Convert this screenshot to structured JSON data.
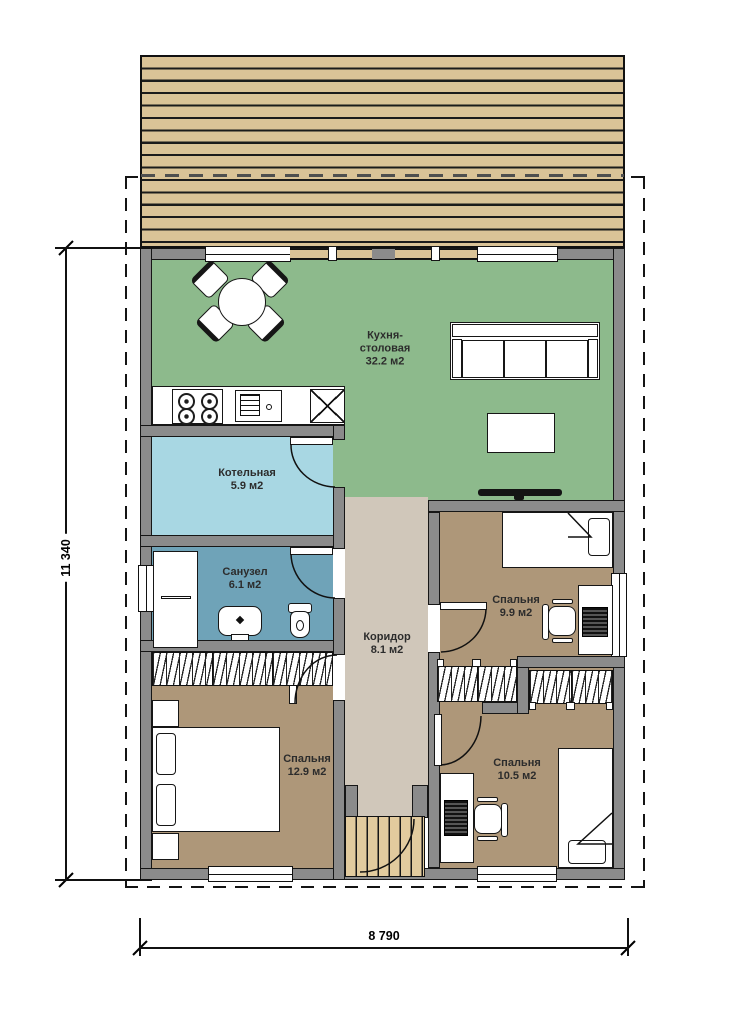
{
  "plan": {
    "type": "floor-plan",
    "dimensions": {
      "vertical": "11 340",
      "horizontal": "8 790"
    },
    "rooms": [
      {
        "id": "kitchen-dining",
        "lines": [
          "Кухня-",
          "столовая"
        ],
        "area": "32.2 м2"
      },
      {
        "id": "boiler-room",
        "lines": [
          "Котельная"
        ],
        "area": "5.9 м2"
      },
      {
        "id": "bathroom",
        "lines": [
          "Санузел"
        ],
        "area": "6.1 м2"
      },
      {
        "id": "corridor",
        "lines": [
          "Коридор"
        ],
        "area": "8.1 м2"
      },
      {
        "id": "bedroom-1",
        "lines": [
          "Спальня"
        ],
        "area": "9.9 м2"
      },
      {
        "id": "bedroom-2",
        "lines": [
          "Спальня"
        ],
        "area": "12.9 м2"
      },
      {
        "id": "bedroom-3",
        "lines": [
          "Спальня"
        ],
        "area": "10.5 м2"
      }
    ],
    "colors": {
      "kitchen": "#8DBA8C",
      "boiler": "#A8D7E3",
      "bathroom": "#6FA3B8",
      "corridor": "#D0C7BA",
      "bedroom": "#AE9779",
      "deck_plank": "#DAC397",
      "porch_plank": "#E2CB9E",
      "wall": "#8B8B8B"
    }
  }
}
